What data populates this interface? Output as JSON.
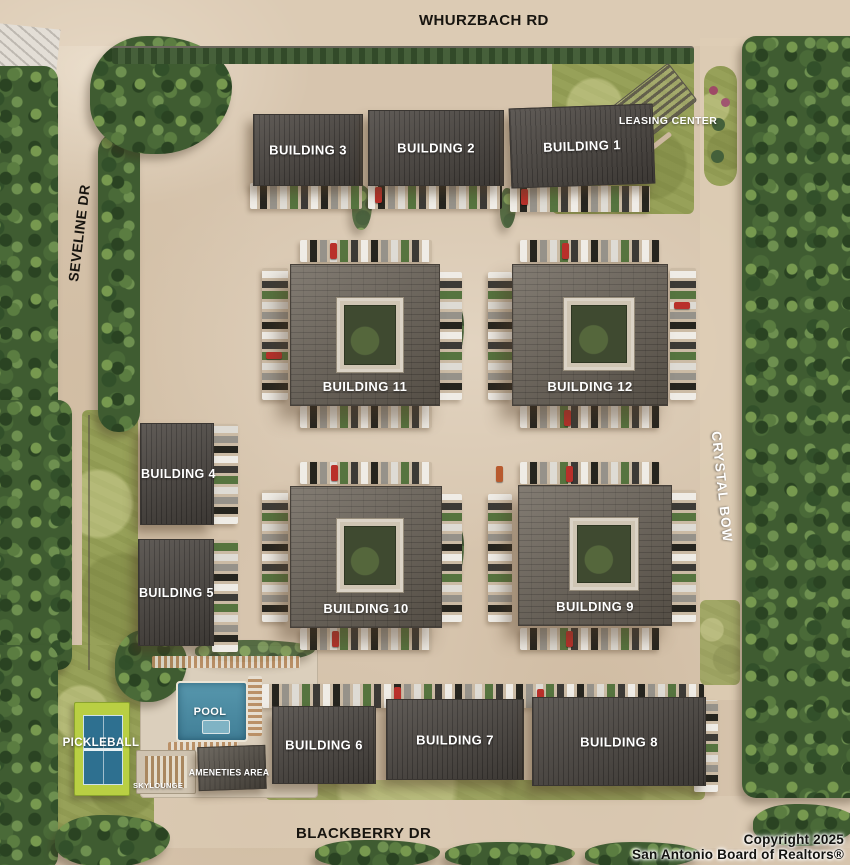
{
  "roads": {
    "whurzbach": "WHURZBACH RD",
    "seveline": "SEVELINE DR",
    "crystal_bow": "CRYSTAL BOW",
    "blackberry": "BLACKBERRY DR"
  },
  "buildings": {
    "b1": {
      "label": "BUILDING 1"
    },
    "b2": {
      "label": "BUILDING 2"
    },
    "b3": {
      "label": "BUILDING 3"
    },
    "b4": {
      "label": "BUILDING 4"
    },
    "b5": {
      "label": "BUILDING 5"
    },
    "b6": {
      "label": "BUILDING 6"
    },
    "b7": {
      "label": "BUILDING 7"
    },
    "b8": {
      "label": "BUILDING 8"
    },
    "b9": {
      "label": "BUILDING 9"
    },
    "b10": {
      "label": "BUILDING 10"
    },
    "b11": {
      "label": "BUILDING 11"
    },
    "b12": {
      "label": "BUILDING 12"
    }
  },
  "amenities": {
    "leasing_center": "LEASING CENTER",
    "pool": "POOL",
    "pickleball": "PICKLEBALL",
    "amenities_area": "AMENETIES AREA",
    "skylounge": "SKYLOUNGE"
  },
  "copyright": {
    "line1": "Copyright 2025",
    "line2": "San Antonio Board of Realtors®"
  },
  "colors": {
    "pavement": "#d7c5ae",
    "tree_dark": "#3f5c31",
    "grass": "#97a159",
    "roof_dark": "#4d4843",
    "roof_court": "#6b6358",
    "pool_water": "#4e8fa6",
    "pickleball_green": "#b9cf43",
    "pickleball_court": "#2e7090",
    "label_white": "#ffffff",
    "label_black": "#17140f"
  }
}
